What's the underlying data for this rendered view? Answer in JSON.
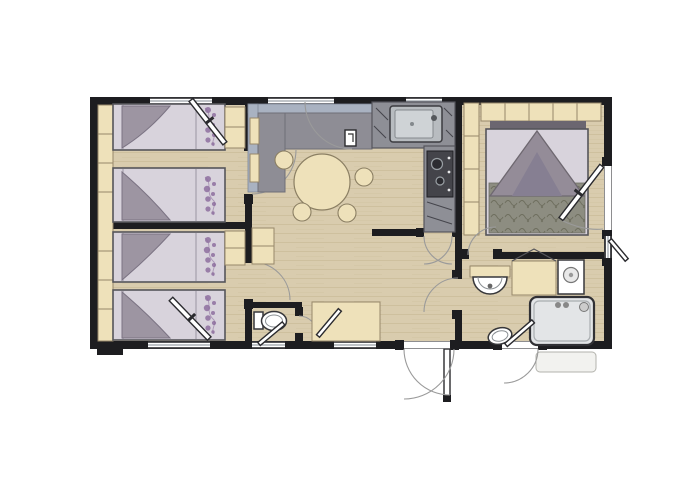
{
  "meta": {
    "title": "Mobile home floor plan",
    "description": "Top-down architectural floor plan of a three-bedroom mobile home with living-dining area, kitchen, two WCs, shower room and entrance door"
  },
  "colors": {
    "wall": "#1d1d20",
    "floor": "#d9ccae",
    "floorGrain": "#c0ad89",
    "cabinet": "#eee1ba",
    "cabinetEdge": "#97876a",
    "sheet": "#d8d3dc",
    "blanket": "#9d95a2",
    "floral": "#8e6f9f",
    "sofaBack": "#a9b2c1",
    "sofaSeat": "#8e8d95",
    "counter": "#8e8f96",
    "steel": "#b8bcc0",
    "shower": "#e3e5e7",
    "fixture": "#ffffff",
    "fixtureEdge": "#37373a",
    "arc": "#9a9a9a",
    "spread": "#8d8d81",
    "spreadLeaf": "#6e6e5e",
    "canopy": "#948c98",
    "canopyDark": "#867f92",
    "headboard": "#6b6670",
    "outline": "#55555a"
  },
  "floorplan": {
    "type": "mobile-home",
    "rooms": [
      {
        "id": "bedroom-1",
        "name": "Twin bedroom 1",
        "furniture": [
          "wardrobe shelves",
          "twin bed",
          "twin bed",
          "corner cabinet",
          "casement window"
        ]
      },
      {
        "id": "bedroom-2",
        "name": "Twin bedroom 2",
        "furniture": [
          "wardrobe shelves",
          "twin bed",
          "twin bed",
          "corner cabinet",
          "casement window"
        ]
      },
      {
        "id": "living-dining",
        "name": "Living / dining area",
        "furniture": [
          "L-shaped sofa",
          "round dining table",
          "stool",
          "stool",
          "stool",
          "stool"
        ]
      },
      {
        "id": "kitchen",
        "name": "Kitchen",
        "furniture": [
          "stainless sink",
          "cooktop with two burners",
          "counter"
        ]
      },
      {
        "id": "wc",
        "name": "WC",
        "furniture": [
          "toilet",
          "casement window"
        ]
      },
      {
        "id": "entry-hall",
        "name": "Entry hall",
        "furniture": [
          "storage closet",
          "entrance door"
        ]
      },
      {
        "id": "master-bedroom",
        "name": "Master bedroom",
        "furniture": [
          "double bed",
          "overhead wardrobes",
          "tall wardrobe",
          "exterior door"
        ]
      },
      {
        "id": "bathroom",
        "name": "Bathroom",
        "furniture": [
          "washbasin",
          "storage counter",
          "water heater",
          "shower cabin",
          "toilet",
          "exterior door"
        ]
      }
    ],
    "counts": {
      "twin_beds": 4,
      "double_beds": 1,
      "stools": 4,
      "toilets": 2,
      "showers": 1,
      "sinks": 2,
      "windows": 7,
      "exterior_doors": 3
    }
  }
}
